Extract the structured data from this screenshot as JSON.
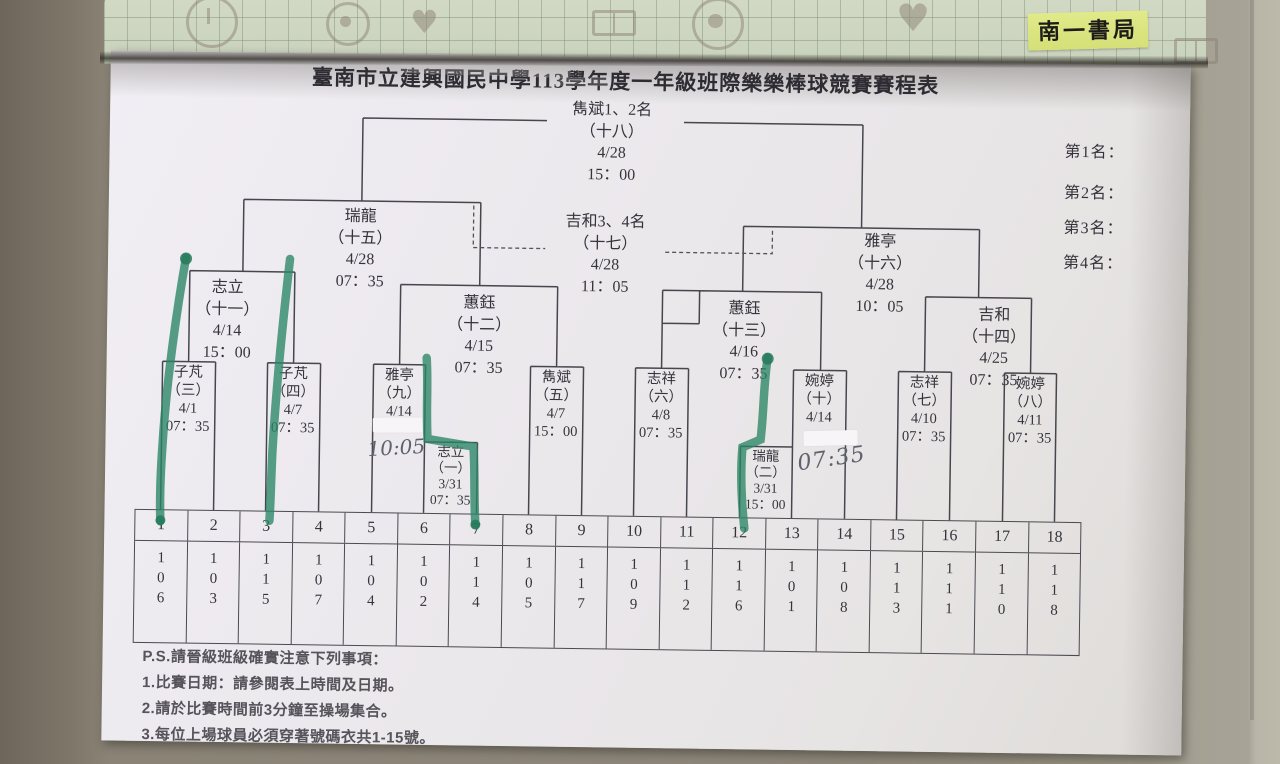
{
  "photo": {
    "bookshop_label": "南一書局",
    "marker_color": "#2a8565",
    "label_bg": "#d9e47f",
    "paper_color": "#ebe8ec"
  },
  "title": "臺南市立建興國民中學113學年度一年級班際樂樂棒球競賽賽程表",
  "rankings": {
    "r1": "第1名：",
    "r2": "第2名：",
    "r3": "第3名：",
    "r4": "第4名："
  },
  "matches": {
    "final": {
      "name": "雋斌1、2名",
      "no": "（十八）",
      "date": "4/28",
      "time": "15：00"
    },
    "third": {
      "name": "吉和3、4名",
      "no": "（十七）",
      "date": "4/28",
      "time": "11：05"
    },
    "sf_left": {
      "name": "瑞龍",
      "no": "（十五）",
      "date": "4/28",
      "time": "07：35"
    },
    "sf_right": {
      "name": "雅亭",
      "no": "（十六）",
      "date": "4/28",
      "time": "10：05"
    },
    "qf11": {
      "name": "志立",
      "no": "（十一）",
      "date": "4/14",
      "time": "15：00"
    },
    "qf12": {
      "name": "蕙鈺",
      "no": "（十二）",
      "date": "4/15",
      "time": "07：35"
    },
    "qf13": {
      "name": "蕙鈺",
      "no": "（十三）",
      "date": "4/16",
      "time": "07：35"
    },
    "qf14": {
      "name": "吉和",
      "no": "（十四）",
      "date": "4/25",
      "time": "07：35"
    },
    "g1": {
      "name": "志立",
      "no": "（一）",
      "date": "3/31",
      "time": "07：35"
    },
    "g2": {
      "name": "瑞龍",
      "no": "（二）",
      "date": "3/31",
      "time": "15：00"
    },
    "g3": {
      "name": "子芃",
      "no": "（三）",
      "date": "4/1",
      "time": "07：35"
    },
    "g4": {
      "name": "子芃",
      "no": "（四）",
      "date": "4/7",
      "time": "07：35"
    },
    "g5": {
      "name": "雋斌",
      "no": "（五）",
      "date": "4/7",
      "time": "15：00"
    },
    "g6": {
      "name": "志祥",
      "no": "（六）",
      "date": "4/8",
      "time": "07：35"
    },
    "g7": {
      "name": "志祥",
      "no": "（七）",
      "date": "4/10",
      "time": "07：35"
    },
    "g8": {
      "name": "婉婷",
      "no": "（八）",
      "date": "4/11",
      "time": "07：35"
    },
    "g9": {
      "name": "雅亭",
      "no": "（九）",
      "date": "4/14",
      "time_handwritten": "10:05"
    },
    "g10": {
      "name": "婉婷",
      "no": "（十）",
      "date": "4/14",
      "time_handwritten": "07:35"
    }
  },
  "table": {
    "positions": [
      "1",
      "2",
      "3",
      "4",
      "5",
      "6",
      "7",
      "8",
      "9",
      "10",
      "11",
      "12",
      "13",
      "14",
      "15",
      "16",
      "17",
      "18"
    ],
    "classes": [
      "106",
      "103",
      "115",
      "107",
      "104",
      "102",
      "114",
      "105",
      "117",
      "109",
      "112",
      "116",
      "101",
      "108",
      "113",
      "111",
      "110",
      "118"
    ]
  },
  "notes": {
    "heading": "P.S.請晉級班級確實注意下列事項：",
    "n1": "1.比賽日期：請參閱表上時間及日期。",
    "n2": "2.請於比賽時間前3分鐘至操場集合。",
    "n3": "3.每位上場球員必須穿著號碼衣共1-15號。"
  }
}
